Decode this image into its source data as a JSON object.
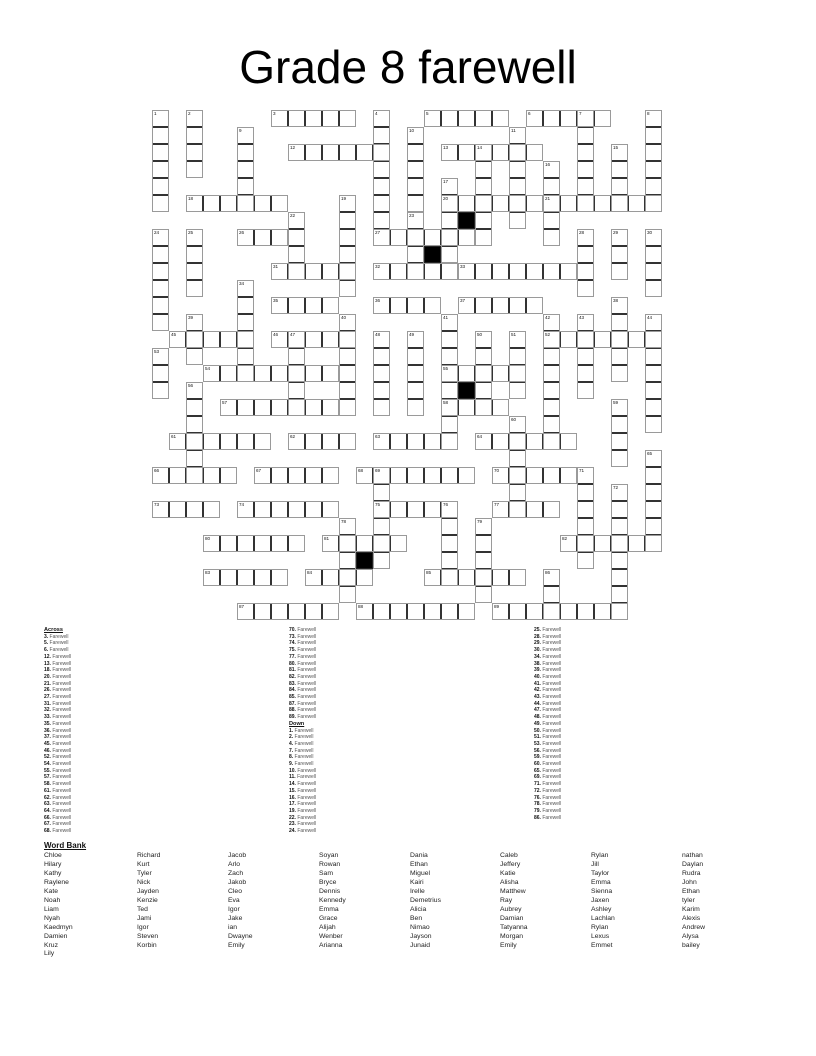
{
  "title": "Grade 8 farewell",
  "grid": {
    "cell_px": 17,
    "rows": 30,
    "cols": 30,
    "line_color": "#333333",
    "black_color": "#000000",
    "black_cells": [
      [
        6,
        18
      ],
      [
        8,
        16
      ],
      [
        16,
        18
      ],
      [
        26,
        12
      ]
    ],
    "words": [
      {
        "n": 3,
        "d": "A",
        "r": 0,
        "c": 7,
        "l": 5
      },
      {
        "n": 5,
        "d": "A",
        "r": 0,
        "c": 16,
        "l": 5
      },
      {
        "n": 6,
        "d": "A",
        "r": 0,
        "c": 22,
        "l": 5
      },
      {
        "n": 12,
        "d": "A",
        "r": 2,
        "c": 8,
        "l": 6
      },
      {
        "n": 13,
        "d": "A",
        "r": 2,
        "c": 17,
        "l": 6
      },
      {
        "n": 18,
        "d": "A",
        "r": 5,
        "c": 2,
        "l": 6
      },
      {
        "n": 20,
        "d": "A",
        "r": 5,
        "c": 17,
        "l": 6
      },
      {
        "n": 21,
        "d": "A",
        "r": 5,
        "c": 23,
        "l": 7
      },
      {
        "n": 26,
        "d": "A",
        "r": 7,
        "c": 5,
        "l": 3
      },
      {
        "n": 27,
        "d": "A",
        "r": 7,
        "c": 13,
        "l": 6
      },
      {
        "n": 31,
        "d": "A",
        "r": 9,
        "c": 7,
        "l": 5
      },
      {
        "n": 32,
        "d": "A",
        "r": 9,
        "c": 13,
        "l": 5
      },
      {
        "n": 33,
        "d": "A",
        "r": 9,
        "c": 18,
        "l": 7
      },
      {
        "n": 35,
        "d": "A",
        "r": 11,
        "c": 7,
        "l": 4
      },
      {
        "n": 36,
        "d": "A",
        "r": 11,
        "c": 13,
        "l": 4
      },
      {
        "n": 37,
        "d": "A",
        "r": 11,
        "c": 18,
        "l": 5
      },
      {
        "n": 45,
        "d": "A",
        "r": 13,
        "c": 1,
        "l": 5
      },
      {
        "n": 46,
        "d": "A",
        "r": 13,
        "c": 7,
        "l": 5
      },
      {
        "n": 52,
        "d": "A",
        "r": 13,
        "c": 23,
        "l": 7
      },
      {
        "n": 54,
        "d": "A",
        "r": 15,
        "c": 3,
        "l": 8
      },
      {
        "n": 55,
        "d": "A",
        "r": 15,
        "c": 17,
        "l": 5
      },
      {
        "n": 57,
        "d": "A",
        "r": 17,
        "c": 4,
        "l": 7
      },
      {
        "n": 58,
        "d": "A",
        "r": 17,
        "c": 17,
        "l": 4
      },
      {
        "n": 61,
        "d": "A",
        "r": 19,
        "c": 1,
        "l": 6
      },
      {
        "n": 62,
        "d": "A",
        "r": 19,
        "c": 8,
        "l": 4
      },
      {
        "n": 63,
        "d": "A",
        "r": 19,
        "c": 13,
        "l": 5
      },
      {
        "n": 64,
        "d": "A",
        "r": 19,
        "c": 19,
        "l": 6
      },
      {
        "n": 66,
        "d": "A",
        "r": 21,
        "c": 0,
        "l": 5
      },
      {
        "n": 67,
        "d": "A",
        "r": 21,
        "c": 6,
        "l": 5
      },
      {
        "n": 68,
        "d": "A",
        "r": 21,
        "c": 12,
        "l": 7
      },
      {
        "n": 70,
        "d": "A",
        "r": 21,
        "c": 20,
        "l": 5
      },
      {
        "n": 73,
        "d": "A",
        "r": 23,
        "c": 0,
        "l": 4
      },
      {
        "n": 74,
        "d": "A",
        "r": 23,
        "c": 5,
        "l": 6
      },
      {
        "n": 75,
        "d": "A",
        "r": 23,
        "c": 13,
        "l": 5
      },
      {
        "n": 77,
        "d": "A",
        "r": 23,
        "c": 20,
        "l": 4
      },
      {
        "n": 80,
        "d": "A",
        "r": 25,
        "c": 3,
        "l": 6
      },
      {
        "n": 81,
        "d": "A",
        "r": 25,
        "c": 10,
        "l": 5
      },
      {
        "n": 82,
        "d": "A",
        "r": 25,
        "c": 24,
        "l": 6
      },
      {
        "n": 83,
        "d": "A",
        "r": 27,
        "c": 3,
        "l": 5
      },
      {
        "n": 84,
        "d": "A",
        "r": 27,
        "c": 9,
        "l": 4
      },
      {
        "n": 85,
        "d": "A",
        "r": 27,
        "c": 16,
        "l": 6
      },
      {
        "n": 87,
        "d": "A",
        "r": 29,
        "c": 5,
        "l": 6
      },
      {
        "n": 88,
        "d": "A",
        "r": 29,
        "c": 12,
        "l": 7
      },
      {
        "n": 89,
        "d": "A",
        "r": 29,
        "c": 20,
        "l": 8
      },
      {
        "n": 1,
        "d": "D",
        "r": 0,
        "c": 0,
        "l": 6
      },
      {
        "n": 2,
        "d": "D",
        "r": 0,
        "c": 2,
        "l": 4
      },
      {
        "n": 4,
        "d": "D",
        "r": 0,
        "c": 13,
        "l": 8
      },
      {
        "n": 7,
        "d": "D",
        "r": 0,
        "c": 25,
        "l": 6
      },
      {
        "n": 8,
        "d": "D",
        "r": 0,
        "c": 29,
        "l": 6
      },
      {
        "n": 9,
        "d": "D",
        "r": 1,
        "c": 5,
        "l": 5
      },
      {
        "n": 10,
        "d": "D",
        "r": 1,
        "c": 15,
        "l": 5
      },
      {
        "n": 11,
        "d": "D",
        "r": 1,
        "c": 21,
        "l": 6
      },
      {
        "n": 14,
        "d": "D",
        "r": 2,
        "c": 19,
        "l": 6
      },
      {
        "n": 15,
        "d": "D",
        "r": 2,
        "c": 27,
        "l": 4
      },
      {
        "n": 16,
        "d": "D",
        "r": 3,
        "c": 23,
        "l": 5
      },
      {
        "n": 17,
        "d": "D",
        "r": 4,
        "c": 17,
        "l": 5
      },
      {
        "n": 19,
        "d": "D",
        "r": 5,
        "c": 11,
        "l": 6
      },
      {
        "n": 22,
        "d": "D",
        "r": 6,
        "c": 8,
        "l": 4
      },
      {
        "n": 23,
        "d": "D",
        "r": 6,
        "c": 15,
        "l": 4
      },
      {
        "n": 24,
        "d": "D",
        "r": 7,
        "c": 0,
        "l": 6
      },
      {
        "n": 25,
        "d": "D",
        "r": 7,
        "c": 2,
        "l": 4
      },
      {
        "n": 28,
        "d": "D",
        "r": 7,
        "c": 25,
        "l": 4
      },
      {
        "n": 29,
        "d": "D",
        "r": 7,
        "c": 27,
        "l": 3
      },
      {
        "n": 30,
        "d": "D",
        "r": 7,
        "c": 29,
        "l": 4
      },
      {
        "n": 34,
        "d": "D",
        "r": 10,
        "c": 5,
        "l": 6
      },
      {
        "n": 38,
        "d": "D",
        "r": 11,
        "c": 27,
        "l": 5
      },
      {
        "n": 39,
        "d": "D",
        "r": 12,
        "c": 2,
        "l": 3
      },
      {
        "n": 40,
        "d": "D",
        "r": 12,
        "c": 11,
        "l": 6
      },
      {
        "n": 41,
        "d": "D",
        "r": 12,
        "c": 17,
        "l": 8
      },
      {
        "n": 42,
        "d": "D",
        "r": 12,
        "c": 23,
        "l": 8
      },
      {
        "n": 43,
        "d": "D",
        "r": 12,
        "c": 25,
        "l": 5
      },
      {
        "n": 44,
        "d": "D",
        "r": 12,
        "c": 29,
        "l": 7
      },
      {
        "n": 47,
        "d": "D",
        "r": 13,
        "c": 8,
        "l": 5
      },
      {
        "n": 48,
        "d": "D",
        "r": 13,
        "c": 13,
        "l": 5
      },
      {
        "n": 49,
        "d": "D",
        "r": 13,
        "c": 15,
        "l": 5
      },
      {
        "n": 50,
        "d": "D",
        "r": 13,
        "c": 19,
        "l": 5
      },
      {
        "n": 51,
        "d": "D",
        "r": 13,
        "c": 21,
        "l": 4
      },
      {
        "n": 53,
        "d": "D",
        "r": 14,
        "c": 0,
        "l": 3
      },
      {
        "n": 56,
        "d": "D",
        "r": 16,
        "c": 2,
        "l": 6
      },
      {
        "n": 59,
        "d": "D",
        "r": 17,
        "c": 27,
        "l": 4
      },
      {
        "n": 60,
        "d": "D",
        "r": 18,
        "c": 21,
        "l": 6
      },
      {
        "n": 65,
        "d": "D",
        "r": 20,
        "c": 29,
        "l": 6
      },
      {
        "n": 69,
        "d": "D",
        "r": 21,
        "c": 13,
        "l": 6
      },
      {
        "n": 71,
        "d": "D",
        "r": 21,
        "c": 25,
        "l": 6
      },
      {
        "n": 72,
        "d": "D",
        "r": 22,
        "c": 27,
        "l": 8
      },
      {
        "n": 76,
        "d": "D",
        "r": 23,
        "c": 17,
        "l": 5
      },
      {
        "n": 78,
        "d": "D",
        "r": 24,
        "c": 11,
        "l": 5
      },
      {
        "n": 79,
        "d": "D",
        "r": 24,
        "c": 19,
        "l": 5
      },
      {
        "n": 86,
        "d": "D",
        "r": 27,
        "c": 23,
        "l": 3
      }
    ]
  },
  "clues": {
    "across_label": "Across",
    "down_label": "Down",
    "clue_word": "Farewell",
    "across_numbers": [
      3,
      5,
      6,
      12,
      13,
      18,
      20,
      21,
      26,
      27,
      31,
      32,
      33,
      35,
      36,
      37,
      45,
      46,
      52,
      54,
      55,
      57,
      58,
      61,
      62,
      63,
      64,
      66,
      67,
      68,
      70,
      73,
      74,
      75,
      77,
      80,
      81,
      82,
      83,
      84,
      85,
      87,
      88,
      89
    ],
    "down_numbers": [
      1,
      2,
      4,
      7,
      8,
      9,
      10,
      11,
      14,
      15,
      16,
      17,
      19,
      22,
      23,
      24,
      25,
      28,
      29,
      30,
      34,
      38,
      39,
      40,
      41,
      42,
      43,
      44,
      47,
      48,
      49,
      50,
      51,
      53,
      56,
      59,
      60,
      65,
      69,
      71,
      72,
      76,
      78,
      79,
      86
    ],
    "column_split": {
      "across_in_col1": 30,
      "down_in_col2": 16
    }
  },
  "word_bank": {
    "label": "Word Bank",
    "columns": [
      [
        "Chloe",
        "Hilary",
        "Kathy",
        "Raylene",
        "Kate",
        "Noah",
        "Liam",
        "Nyah",
        "Kaedmyn",
        "Damien",
        "Kruz",
        "Lily"
      ],
      [
        "Richard",
        "Kurt",
        "Tyler",
        "Nick",
        "Jayden",
        "Kenzie",
        "Ted",
        "Jami",
        "Igor",
        "Steven",
        "Korbin"
      ],
      [
        "Jacob",
        "Arlo",
        "Zach",
        "Jakob",
        "Cleo",
        "Eva",
        "Igor",
        "Jake",
        "ian",
        "Dwayne",
        "Emily"
      ],
      [
        "Soyan",
        "Rowan",
        "Sam",
        "Bryce",
        "Dennis",
        "Kennedy",
        "Emma",
        "Grace",
        "Alijah",
        "Wenber",
        "Arianna"
      ],
      [
        "Dania",
        "Ethan",
        "Miguel",
        "Kairi",
        "Irelle",
        "Demetrius",
        "Alicia",
        "Ben",
        "Nimao",
        "Jayson",
        "Junaid"
      ],
      [
        "Caleb",
        "Jeffery",
        "Katie",
        "Alisha",
        "Matthew",
        "Ray",
        "Aubrey",
        "Damian",
        "Tatyanna",
        "Morgan",
        "Emily"
      ],
      [
        "Rylan",
        "Jill",
        "Taylor",
        "Emma",
        "Sienna",
        "Jaxen",
        "Ashley",
        "Lachlan",
        "Rylan",
        "Lexus",
        "Emmet"
      ],
      [
        "nathan",
        "Daylan",
        "Rudra",
        "John",
        "Ethan",
        "tyler",
        "Karim",
        "Alexis",
        "Andrew",
        "Alysa",
        "bailey"
      ]
    ]
  }
}
